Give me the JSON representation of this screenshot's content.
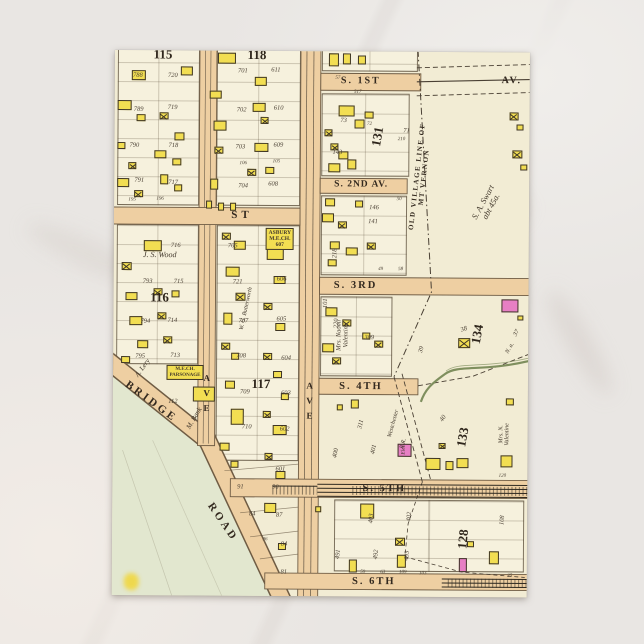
{
  "theme": {
    "card_bg": "#f2ecd4",
    "block_bg": "#f6f1dd",
    "street_fill": "#eecfa2",
    "building_yellow": "#f2de52",
    "building_pink": "#e77fc4",
    "green_area": "#e2e7cf",
    "stream": "#7f8f5e",
    "ink": "#3c332a",
    "backdrop_marble": "#e9e6e3"
  },
  "map": {
    "street_labels": [
      {
        "t": "ST",
        "x": 128,
        "y": 165,
        "s": 11,
        "ls": 4
      },
      {
        "t": "S. 1ST",
        "x": 246,
        "y": 30,
        "s": 10,
        "ls": 2
      },
      {
        "t": "AV.",
        "x": 397,
        "y": 29,
        "s": 10,
        "ls": 2
      },
      {
        "t": "S. 2ND AV.",
        "x": 247,
        "y": 134,
        "s": 9.5,
        "ls": 1
      },
      {
        "t": "S. 3RD",
        "x": 242,
        "y": 234,
        "s": 10.5,
        "ls": 2
      },
      {
        "t": "S. 4TH",
        "x": 248,
        "y": 335,
        "s": 10.5,
        "ls": 2
      },
      {
        "t": "S. 5TH",
        "x": 272,
        "y": 437,
        "s": 10.5,
        "ls": 2
      },
      {
        "t": "S. 6TH",
        "x": 262,
        "y": 530,
        "s": 10.5,
        "ls": 2
      },
      {
        "t": "AVE",
        "x": 93,
        "y": 345,
        "s": 9,
        "vertical": true
      },
      {
        "t": "AVE",
        "x": 196,
        "y": 352,
        "s": 9,
        "vertical": true
      },
      {
        "t": "BRIDGE",
        "x": 38,
        "y": 352,
        "r": 36,
        "s": 11,
        "ls": 3
      },
      {
        "t": "ROAD",
        "x": 110,
        "y": 472,
        "r": 55,
        "s": 11,
        "ls": 3
      },
      {
        "t": "OLD VILLAGE LINE OF MT VERNON",
        "x": 307,
        "y": 125,
        "r": -84,
        "s": 7,
        "ls": 1.5
      }
    ],
    "block_numbers": [
      {
        "t": "115",
        "x": 48,
        "y": 4
      },
      {
        "t": "118",
        "x": 142,
        "y": 4
      },
      {
        "t": "116",
        "x": 46,
        "y": 247
      },
      {
        "t": "117",
        "x": 148,
        "y": 333
      },
      {
        "t": "131",
        "x": 263,
        "y": 85,
        "r": -80
      },
      {
        "t": "134",
        "x": 364,
        "y": 282,
        "r": -80
      },
      {
        "t": "133",
        "x": 350,
        "y": 385,
        "r": -80
      },
      {
        "t": "128",
        "x": 351,
        "y": 487,
        "r": -85
      }
    ],
    "owner_labels": [
      {
        "t": "J. S. Wood",
        "x": 46,
        "y": 205,
        "s": 8
      },
      {
        "t": "ASBURY\nM.E.CH.\n607",
        "x": 166,
        "y": 188,
        "s": 5.5,
        "boxed": true
      },
      {
        "t": "M.E.CH.\nPARSONAGE",
        "x": 72,
        "y": 322,
        "s": 5,
        "boxed": true
      },
      {
        "t": "A. Lery",
        "x": 30,
        "y": 318,
        "r": -55,
        "s": 7
      },
      {
        "t": "M. Bank",
        "x": 82,
        "y": 368,
        "r": -60,
        "s": 7
      },
      {
        "t": "112",
        "x": 60,
        "y": 352,
        "s": 6.5
      },
      {
        "t": "W. G. Butterworth",
        "x": 133,
        "y": 258,
        "r": -78,
        "s": 6
      },
      {
        "t": "Mrs. Naomi\nValentine",
        "x": 230,
        "y": 284,
        "r": -90,
        "s": 6.5
      },
      {
        "t": "Mrs. N. Valentine",
        "x": 392,
        "y": 382,
        "r": -90,
        "s": 6
      },
      {
        "t": "S. A. Swart\nabt 45a.",
        "x": 373,
        "y": 152,
        "r": -62,
        "s": 8.5
      },
      {
        "t": "Westchester",
        "x": 281,
        "y": 372,
        "r": -75,
        "s": 6
      },
      {
        "t": "R.R.",
        "x": 291,
        "y": 392,
        "r": -75,
        "s": 6
      },
      {
        "t": "Elec",
        "x": 292,
        "y": 398,
        "r": -90,
        "s": 5.5
      },
      {
        "t": "N. a.",
        "x": 397,
        "y": 296,
        "r": -60,
        "s": 6
      }
    ],
    "lot_numbers": [
      {
        "t": "788",
        "x": 23,
        "y": 26
      },
      {
        "t": "720",
        "x": 58,
        "y": 26
      },
      {
        "t": "789",
        "x": 24,
        "y": 60
      },
      {
        "t": "719",
        "x": 58,
        "y": 58
      },
      {
        "t": "790",
        "x": 20,
        "y": 96
      },
      {
        "t": "718",
        "x": 59,
        "y": 96
      },
      {
        "t": "791",
        "x": 25,
        "y": 131
      },
      {
        "t": "717",
        "x": 59,
        "y": 133
      },
      {
        "t": "195",
        "x": 18,
        "y": 150,
        "s": 5
      },
      {
        "t": "196",
        "x": 46,
        "y": 149,
        "s": 5
      },
      {
        "t": "701",
        "x": 128,
        "y": 21
      },
      {
        "t": "611",
        "x": 161,
        "y": 20
      },
      {
        "t": "702",
        "x": 127,
        "y": 60
      },
      {
        "t": "610",
        "x": 164,
        "y": 58
      },
      {
        "t": "703",
        "x": 126,
        "y": 97
      },
      {
        "t": "609",
        "x": 164,
        "y": 95
      },
      {
        "t": "106",
        "x": 129,
        "y": 113,
        "s": 5
      },
      {
        "t": "105",
        "x": 162,
        "y": 111,
        "s": 5
      },
      {
        "t": "704",
        "x": 129,
        "y": 136
      },
      {
        "t": "608",
        "x": 159,
        "y": 134
      },
      {
        "t": "716",
        "x": 62,
        "y": 196
      },
      {
        "t": "793",
        "x": 34,
        "y": 232
      },
      {
        "t": "715",
        "x": 65,
        "y": 232
      },
      {
        "t": "794",
        "x": 32,
        "y": 272
      },
      {
        "t": "714",
        "x": 59,
        "y": 271
      },
      {
        "t": "795",
        "x": 27,
        "y": 307
      },
      {
        "t": "713",
        "x": 62,
        "y": 306
      },
      {
        "t": "705",
        "x": 119,
        "y": 196
      },
      {
        "t": "721",
        "x": 124,
        "y": 232
      },
      {
        "t": "707",
        "x": 130,
        "y": 271
      },
      {
        "t": "708",
        "x": 128,
        "y": 306
      },
      {
        "t": "606",
        "x": 168,
        "y": 229
      },
      {
        "t": "605",
        "x": 168,
        "y": 269
      },
      {
        "t": "604",
        "x": 173,
        "y": 308
      },
      {
        "t": "709",
        "x": 132,
        "y": 342
      },
      {
        "t": "603",
        "x": 173,
        "y": 343
      },
      {
        "t": "710",
        "x": 134,
        "y": 377
      },
      {
        "t": "602",
        "x": 172,
        "y": 379
      },
      {
        "t": "601",
        "x": 168,
        "y": 419
      },
      {
        "t": "91",
        "x": 128,
        "y": 437
      },
      {
        "t": "90",
        "x": 163,
        "y": 437
      },
      {
        "t": "84",
        "x": 140,
        "y": 464
      },
      {
        "t": "87",
        "x": 167,
        "y": 465
      },
      {
        "t": "84",
        "x": 172,
        "y": 494
      },
      {
        "t": "96",
        "x": 153,
        "y": 489,
        "s": 5
      },
      {
        "t": "81",
        "x": 172,
        "y": 522
      },
      {
        "t": "57",
        "x": 223,
        "y": 27,
        "s": 5
      },
      {
        "t": "517",
        "x": 243,
        "y": 41,
        "s": 5
      },
      {
        "t": "73",
        "x": 229,
        "y": 70
      },
      {
        "t": "143",
        "x": 223,
        "y": 102
      },
      {
        "t": "71",
        "x": 292,
        "y": 80
      },
      {
        "t": "210",
        "x": 287,
        "y": 88,
        "s": 5
      },
      {
        "t": "72",
        "x": 255,
        "y": 73,
        "s": 5
      },
      {
        "t": "146",
        "x": 260,
        "y": 157
      },
      {
        "t": "141",
        "x": 259,
        "y": 171
      },
      {
        "t": "50",
        "x": 285,
        "y": 148,
        "s": 5
      },
      {
        "t": "218",
        "x": 222,
        "y": 202,
        "r": -90
      },
      {
        "t": "49",
        "x": 267,
        "y": 218,
        "s": 5
      },
      {
        "t": "58",
        "x": 287,
        "y": 218,
        "s": 5
      },
      {
        "t": "101",
        "x": 213,
        "y": 252,
        "r": -90
      },
      {
        "t": "220",
        "x": 224,
        "y": 272,
        "r": -90
      },
      {
        "t": "309",
        "x": 256,
        "y": 287
      },
      {
        "t": "39",
        "x": 309,
        "y": 298,
        "r": -75
      },
      {
        "t": "38",
        "x": 351,
        "y": 278,
        "r": -20
      },
      {
        "t": "37",
        "x": 404,
        "y": 281,
        "r": -60
      },
      {
        "t": "311",
        "x": 249,
        "y": 373,
        "r": -78
      },
      {
        "t": "400",
        "x": 224,
        "y": 402,
        "r": -78
      },
      {
        "t": "401",
        "x": 262,
        "y": 398,
        "r": -78
      },
      {
        "t": "40",
        "x": 331,
        "y": 367,
        "r": -55
      },
      {
        "t": "403",
        "x": 260,
        "y": 467,
        "r": -85
      },
      {
        "t": "402",
        "x": 298,
        "y": 465,
        "r": -85
      },
      {
        "t": "491",
        "x": 227,
        "y": 503,
        "r": -85
      },
      {
        "t": "492",
        "x": 265,
        "y": 503,
        "r": -85
      },
      {
        "t": "493",
        "x": 296,
        "y": 504,
        "r": -85
      },
      {
        "t": "108",
        "x": 391,
        "y": 468,
        "r": -85
      },
      {
        "t": "120",
        "x": 390,
        "y": 424,
        "s": 5
      },
      {
        "t": "25",
        "x": 398,
        "y": 524,
        "s": 5
      },
      {
        "t": "59",
        "x": 251,
        "y": 521,
        "s": 5
      },
      {
        "t": "63",
        "x": 271,
        "y": 521,
        "s": 5
      },
      {
        "t": "109",
        "x": 291,
        "y": 521,
        "s": 5
      },
      {
        "t": "103",
        "x": 311,
        "y": 522,
        "s": 5
      }
    ],
    "buildings": [
      [
        17,
        20,
        14,
        10
      ],
      [
        66,
        16,
        12,
        9
      ],
      [
        3,
        50,
        14,
        10
      ],
      [
        45,
        62,
        9,
        7,
        "x"
      ],
      [
        22,
        64,
        9,
        7
      ],
      [
        60,
        82,
        10,
        8
      ],
      [
        3,
        92,
        8,
        7
      ],
      [
        40,
        100,
        12,
        8
      ],
      [
        14,
        112,
        8,
        7,
        "x"
      ],
      [
        58,
        108,
        9,
        7
      ],
      [
        3,
        128,
        12,
        9
      ],
      [
        46,
        124,
        8,
        10
      ],
      [
        20,
        140,
        9,
        7,
        "x"
      ],
      [
        60,
        134,
        8,
        7
      ],
      [
        103,
        2,
        18,
        11
      ],
      [
        140,
        26,
        12,
        9
      ],
      [
        95,
        40,
        12,
        8
      ],
      [
        138,
        52,
        13,
        9
      ],
      [
        99,
        70,
        13,
        10
      ],
      [
        146,
        66,
        8,
        7,
        "x"
      ],
      [
        140,
        92,
        14,
        9
      ],
      [
        100,
        96,
        9,
        7,
        "x"
      ],
      [
        133,
        118,
        9,
        7,
        "x"
      ],
      [
        151,
        116,
        9,
        7
      ],
      [
        96,
        128,
        8,
        11
      ],
      [
        92,
        150,
        6,
        8
      ],
      [
        104,
        152,
        6,
        8
      ],
      [
        116,
        152,
        6,
        8
      ],
      [
        30,
        190,
        18,
        11
      ],
      [
        8,
        212,
        10,
        8,
        "x"
      ],
      [
        12,
        242,
        12,
        8
      ],
      [
        40,
        238,
        9,
        7,
        "x"
      ],
      [
        58,
        240,
        8,
        7
      ],
      [
        16,
        266,
        13,
        9
      ],
      [
        44,
        262,
        9,
        7,
        "x"
      ],
      [
        24,
        290,
        11,
        8
      ],
      [
        50,
        286,
        9,
        7,
        "x"
      ],
      [
        8,
        306,
        9,
        7
      ],
      [
        108,
        182,
        9,
        7,
        "x"
      ],
      [
        120,
        190,
        12,
        9
      ],
      [
        112,
        216,
        14,
        10
      ],
      [
        122,
        242,
        10,
        8,
        "x"
      ],
      [
        110,
        262,
        9,
        12
      ],
      [
        108,
        292,
        9,
        7,
        "x"
      ],
      [
        118,
        302,
        8,
        7
      ],
      [
        112,
        330,
        10,
        8
      ],
      [
        118,
        358,
        13,
        16
      ],
      [
        107,
        392,
        10,
        8
      ],
      [
        118,
        410,
        8,
        7
      ],
      [
        153,
        196,
        17,
        13
      ],
      [
        160,
        225,
        12,
        8
      ],
      [
        150,
        252,
        9,
        7,
        "x"
      ],
      [
        162,
        272,
        10,
        8
      ],
      [
        150,
        302,
        9,
        7,
        "x"
      ],
      [
        160,
        320,
        9,
        7
      ],
      [
        168,
        342,
        8,
        7
      ],
      [
        150,
        360,
        8,
        7,
        "x"
      ],
      [
        160,
        374,
        14,
        10
      ],
      [
        152,
        402,
        8,
        7,
        "x"
      ],
      [
        163,
        420,
        10,
        8
      ],
      [
        80,
        336,
        22,
        15
      ],
      [
        152,
        452,
        12,
        10
      ],
      [
        166,
        492,
        8,
        7
      ],
      [
        214,
        2,
        10,
        13
      ],
      [
        228,
        2,
        8,
        11
      ],
      [
        243,
        4,
        8,
        9
      ],
      [
        224,
        54,
        16,
        11
      ],
      [
        240,
        68,
        10,
        9
      ],
      [
        210,
        78,
        8,
        7,
        "x"
      ],
      [
        216,
        92,
        8,
        7,
        "x"
      ],
      [
        224,
        100,
        10,
        8
      ],
      [
        214,
        112,
        12,
        9
      ],
      [
        233,
        108,
        9,
        10
      ],
      [
        250,
        60,
        9,
        7
      ],
      [
        211,
        147,
        10,
        8
      ],
      [
        208,
        162,
        12,
        9
      ],
      [
        224,
        170,
        9,
        7,
        "x"
      ],
      [
        241,
        149,
        8,
        7
      ],
      [
        216,
        190,
        10,
        8
      ],
      [
        232,
        196,
        12,
        8
      ],
      [
        253,
        191,
        9,
        7,
        "x"
      ],
      [
        214,
        208,
        9,
        7
      ],
      [
        212,
        256,
        12,
        9
      ],
      [
        209,
        292,
        12,
        9
      ],
      [
        229,
        268,
        9,
        7,
        "x"
      ],
      [
        249,
        281,
        8,
        7
      ],
      [
        261,
        289,
        9,
        7,
        "x"
      ],
      [
        219,
        306,
        9,
        7,
        "x"
      ],
      [
        345,
        286,
        12,
        10,
        "x"
      ],
      [
        388,
        247,
        17,
        13,
        "p"
      ],
      [
        404,
        263,
        6,
        5
      ],
      [
        285,
        392,
        14,
        13,
        "p"
      ],
      [
        313,
        406,
        15,
        12
      ],
      [
        333,
        409,
        8,
        9
      ],
      [
        344,
        406,
        12,
        10
      ],
      [
        326,
        391,
        7,
        6,
        "x"
      ],
      [
        393,
        346,
        8,
        7
      ],
      [
        388,
        403,
        12,
        12
      ],
      [
        238,
        348,
        8,
        9
      ],
      [
        224,
        353,
        6,
        6
      ],
      [
        248,
        452,
        14,
        15
      ],
      [
        237,
        508,
        8,
        13
      ],
      [
        283,
        486,
        10,
        8,
        "x"
      ],
      [
        285,
        503,
        9,
        13
      ],
      [
        355,
        489,
        7,
        6
      ],
      [
        347,
        506,
        8,
        14,
        "p"
      ],
      [
        377,
        499,
        10,
        13
      ],
      [
        203,
        455,
        6,
        6
      ],
      [
        395,
        60,
        9,
        8,
        "x"
      ],
      [
        402,
        72,
        7,
        6
      ],
      [
        398,
        98,
        10,
        8,
        "x"
      ],
      [
        406,
        112,
        7,
        6
      ]
    ]
  }
}
